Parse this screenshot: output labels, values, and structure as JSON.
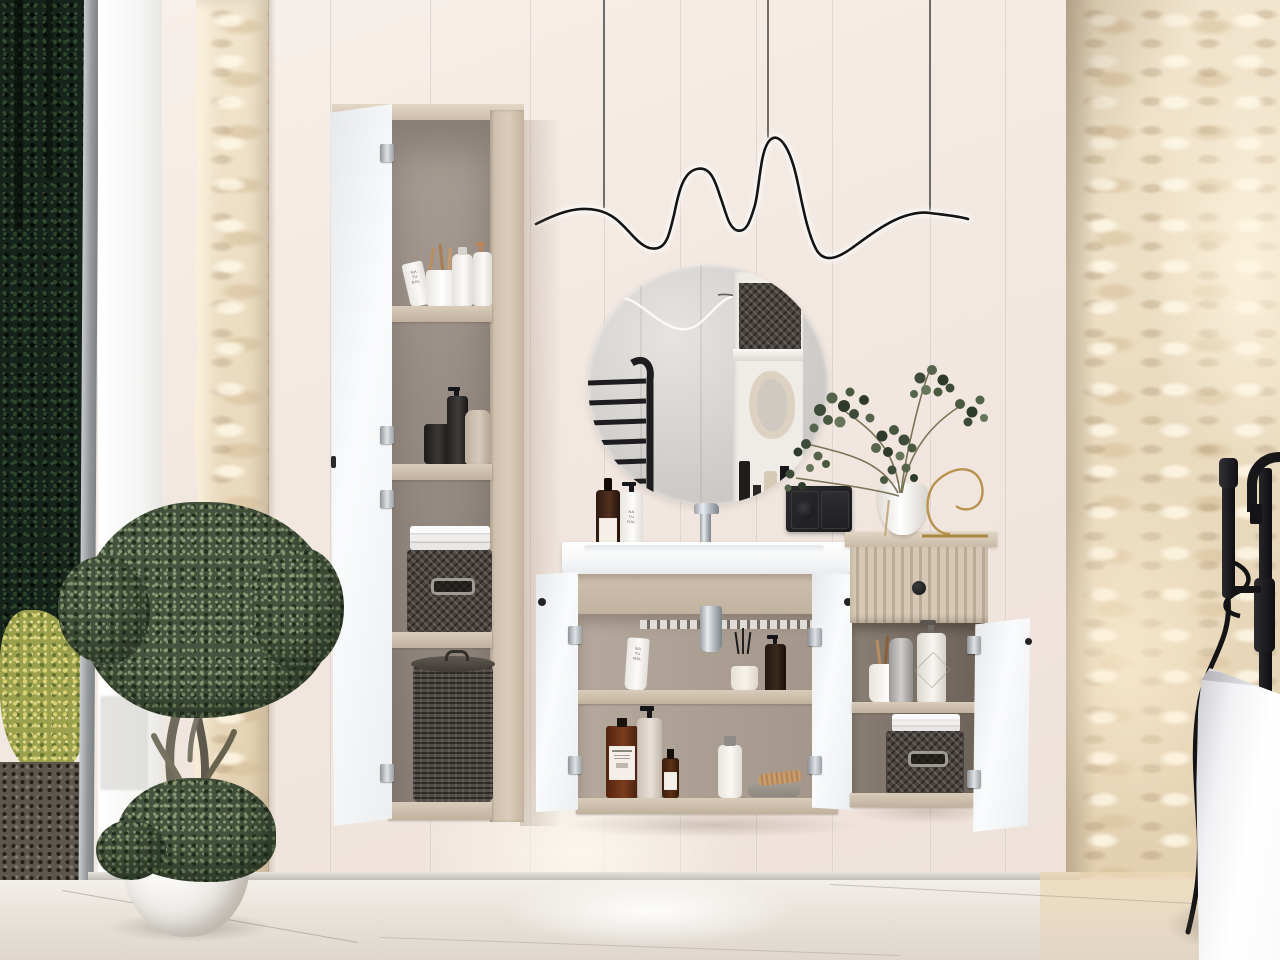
{
  "meta": {
    "title": "Beige bathroom interior with modular vanity furniture set",
    "type": "interior-render"
  },
  "labels": {
    "cosmetic_bottle_countertop": "NA\nTU\nRAL",
    "cosmetic_tube_vanity": "NA\nTU\nRAL",
    "cosmetic_tube_cabinet": "NA\nTU\nRAL"
  },
  "palette": {
    "wall_cream": "#f2e8e1",
    "cabinet_beige": "#d3c4b1",
    "cabinet_interior": "#968a80",
    "door_white": "#f5f6f8",
    "stone_travertine": "#ead9bf",
    "floor_marble": "#ece6df",
    "fixture_black": "#17171a",
    "chrome": "#c9cfd4",
    "foliage_green": "#46543f",
    "amber_glass": "#6e3018",
    "basket_gray": "#4a433e",
    "brass_gold": "#b9924f"
  },
  "objects": {
    "window": "floor-to-ceiling window with forest view",
    "tall_cabinet": "open tall storage column with toiletries, towels, baskets",
    "vanity": "wall-hung washbasin vanity with two open doors",
    "mirror": "round frameless mirror reflecting towel ladder and niche shelf",
    "pendant": "wavy black LED cord pendant light",
    "small_cabinet": "wall cabinet with fluted drawer and open door",
    "plant_vase": "white vase with eucalyptus and brass wire decor",
    "socket": "black double wall socket and switch",
    "tree": "potted olive tree in white planter",
    "bath": "freestanding white bathtub with black floor-mounted tub filler",
    "stone_walls": "textured travertine stone wall panels"
  }
}
